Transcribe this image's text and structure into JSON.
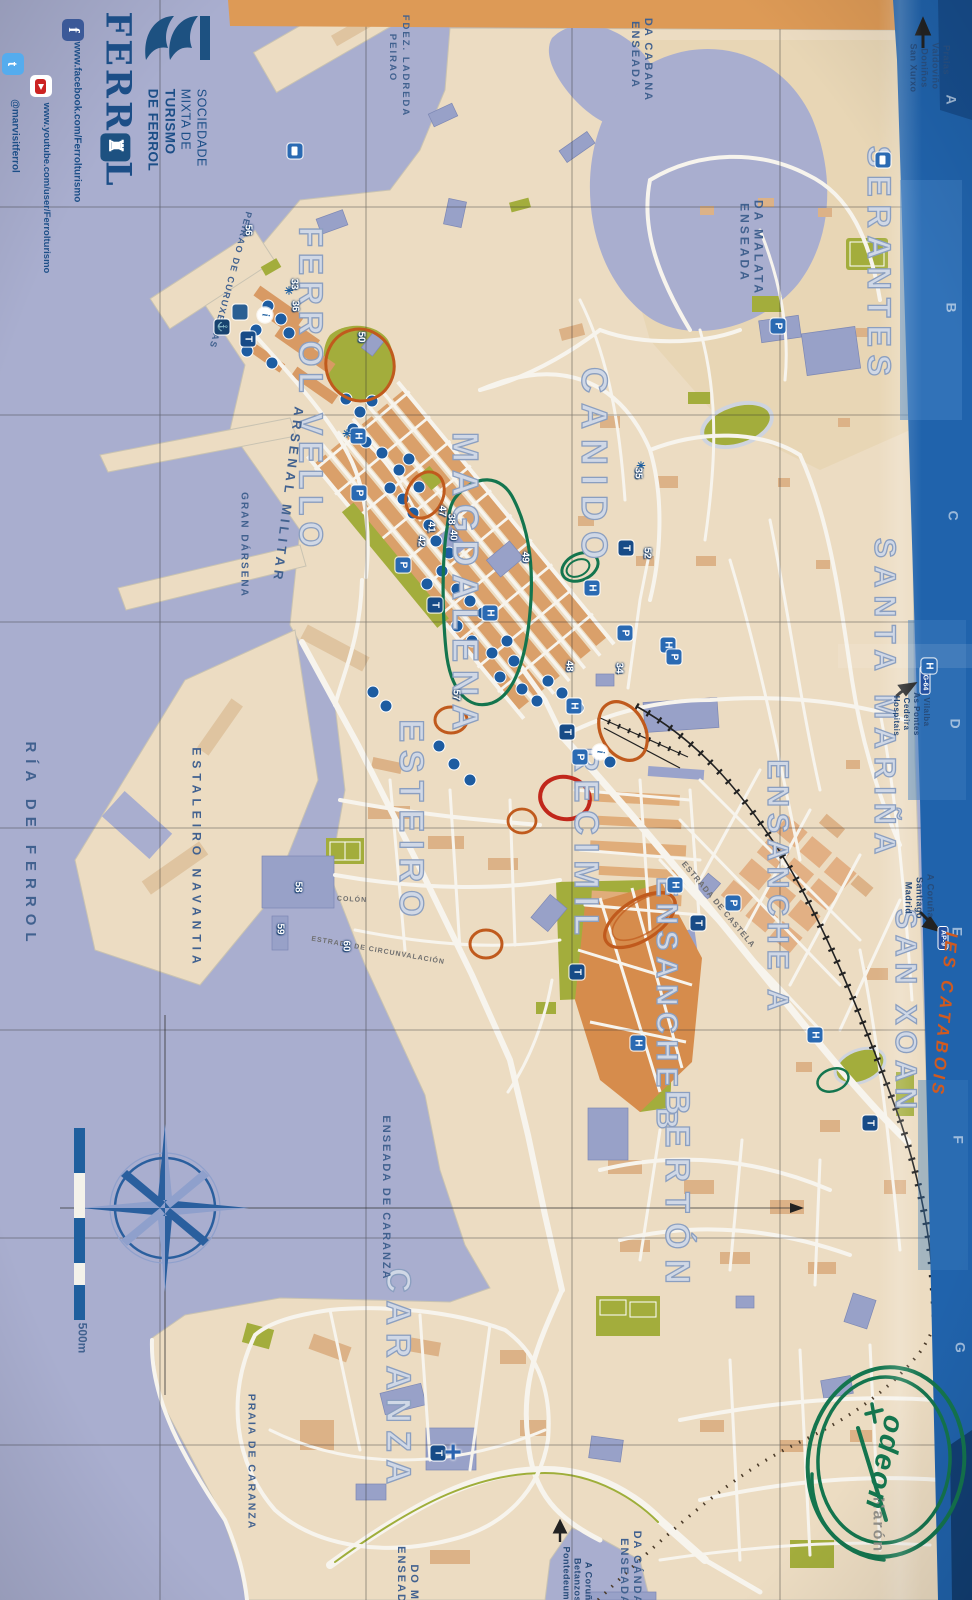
{
  "cover": {
    "title_part1": "FERR",
    "crest_glyph": "♜",
    "title_part2": "L",
    "org_line1": "SOCIEDADE",
    "org_line2": "MIXTA DE",
    "org_line3": "TURISMO",
    "org_line4": "DE FERROL",
    "social": {
      "facebook_icon": "f",
      "facebook": "www.facebook.com/Ferrolturismo",
      "youtube": "www.youtube.com/user/Ferrolturismo",
      "twitter_icon": "t",
      "twitter": "@marvisitferrol"
    }
  },
  "districts": {
    "ferrol_vello": "FERROL VELLO",
    "magdalena": "MAGDALENA",
    "canido": "CANIDO",
    "esteiro": "ESTEIRO",
    "recimil": "RECIMIL",
    "ensanche_a": "ENSANCHE A",
    "ensanche_b": "ENSANCHE B",
    "berton": "BERTÓN",
    "santa_marina": "SANTA MARIÑA",
    "serantes": "SERANTES",
    "san_xoan": "SAN XOAN",
    "caranza": "CARANZA",
    "naron": "Narón"
  },
  "water": {
    "ria": "RÍA DE FERROL",
    "gran_darsena": "GRAN DÁRSENA",
    "cabana_1": "ENSEADA",
    "cabana_2": "DA CABANA",
    "malata_1": "ENSEADA",
    "malata_2": "DA MALATA",
    "enseada_caranza": "ENSEADA DE CARANZA",
    "praia_caranza": "PRAIA DE CARANZA",
    "gandara_1": "ENSEADA",
    "gandara_2": "DA GÁNDARA",
    "monton_1": "ENSEADA",
    "monton_2": "DO MO"
  },
  "port": {
    "arsenal": "ARSENAL MILITAR",
    "navantia": "ESTALEIRO NAVANTIA",
    "peirao_ladreda_1": "PEIRAO",
    "peirao_ladreda_2": "FDEZ. LADREDA",
    "peirao_curuxeiras": "PEIRAO DE CURUXEIRAS"
  },
  "streets": {
    "castela": "ESTRADA DE CASTELA",
    "circunvalacion": "ESTRADA DE CIRCUNVALACIÓN",
    "colon": "COLÓN"
  },
  "directions": {
    "praias": [
      "San Xurxo",
      "Doniños",
      "Valdoviño",
      "Praias"
    ],
    "madrid": [
      "Madrid",
      "Santiago",
      "A Coruña"
    ],
    "hospitais": [
      "Hospitais",
      "Cedeira",
      "As Pontes",
      "Vilalba"
    ],
    "pontedeume": [
      "Pontedeume",
      "Betanzos",
      "A Coruña"
    ]
  },
  "road_shields": {
    "ap9": "AP-9",
    "ag64": "AG-64"
  },
  "poi_legend": {
    "hotel": "H",
    "parking": "P",
    "taxi": "T",
    "info": "i",
    "hospital_cross": "+",
    "anchor": "⚓",
    "viewpoint": "✳"
  },
  "numbers": {
    "n33": "33",
    "n34": "34",
    "n35": "35",
    "n36": "36",
    "n38": "38",
    "n40": "40",
    "n41": "41",
    "n42": "42",
    "n47": "47",
    "n48": "48",
    "n49": "49",
    "n50": "50",
    "n52": "52",
    "n56": "56",
    "n57": "57",
    "n58": "58",
    "n59": "59",
    "n60": "60"
  },
  "grid_letters": [
    "A",
    "B",
    "C",
    "D",
    "E",
    "F",
    "G"
  ],
  "scale_label": "500m",
  "annotations": {
    "ies_catabois": "IES CATABOIS",
    "odeon": "odeon"
  },
  "colors": {
    "water": "#a9aecf",
    "land": "#ecdcc2",
    "park_green": "#a3ad3c",
    "accent_blue": "#1d5fa0",
    "annotation_orange": "#c05a1d",
    "annotation_green": "#14754e",
    "annotation_red": "#c1271b",
    "edge_band_blue": "#2063ac",
    "edge_band_orange": "#dd9a56"
  }
}
